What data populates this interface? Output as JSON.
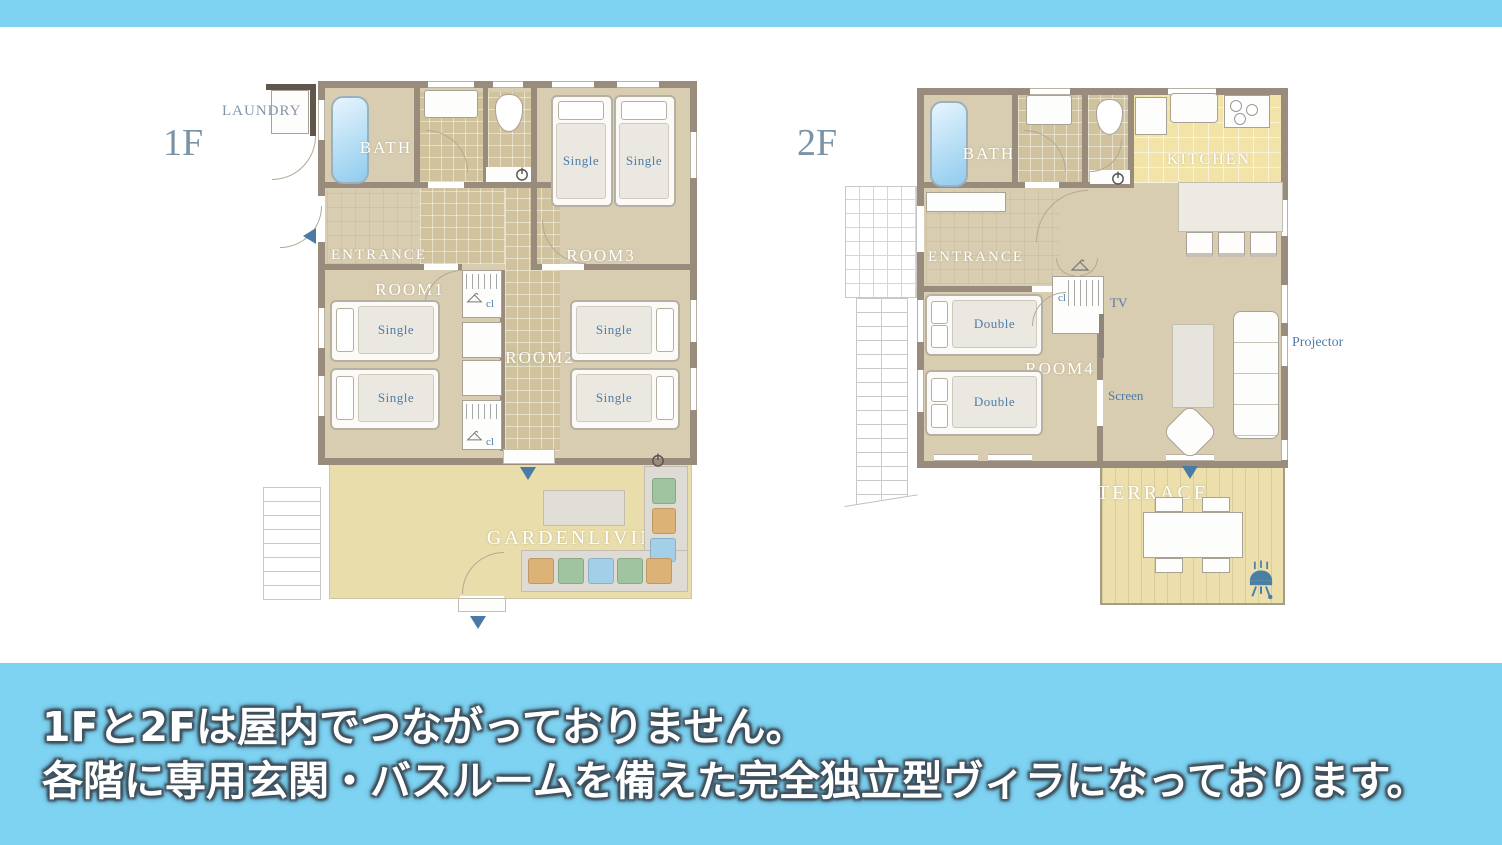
{
  "caption": {
    "line1": "1Fと2Fは屋内でつながっておりません。",
    "line2": "各階に専用玄関・バスルームを備えた完全独立型ヴィラになっております。"
  },
  "floor1": {
    "title": "1F",
    "labels": {
      "laundry": "LAUNDRY",
      "bath": "BATH",
      "entrance": "ENTRANCE",
      "room1": "ROOM1",
      "room2": "ROOM2",
      "room3": "ROOM3",
      "garden_living": "GARDENLIVING"
    },
    "bed_label": "Single",
    "closet_label": "cl"
  },
  "floor2": {
    "title": "2F",
    "labels": {
      "bath": "BATH",
      "entrance": "ENTRANCE",
      "kitchen": "KITCHEN",
      "room4": "ROOM4",
      "terrace": "TERRACE",
      "tv": "TV",
      "screen": "Screen",
      "projector": "Projector"
    },
    "bed_label": "Double",
    "closet_label": "cl"
  },
  "colors": {
    "band_blue": "#7ed3f2",
    "wall_brown": "#9a8c7d",
    "floor_beige": "#d8cdb0",
    "kitchen_yellow": "#f2e3a9",
    "garden_yellow": "#e8ddab",
    "terrace_yellow": "#ecdfab",
    "accent_blue": "#4a7ba6"
  }
}
